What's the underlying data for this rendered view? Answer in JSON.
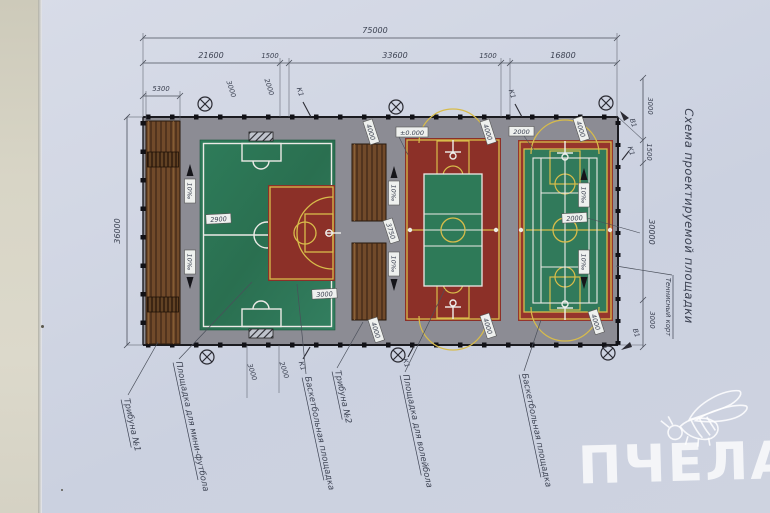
{
  "title": "Схема проектируемой площадки",
  "watermark": "ПЧЕЛА",
  "dims": {
    "overall_width": "75000",
    "seg_football": "21600",
    "gap_left": "1500",
    "seg_middle": "33600",
    "gap_right": "1500",
    "seg_tennis": "16800",
    "tribune_width": "5300",
    "height_left": "36000",
    "right_top": "3000",
    "right_fence": "1500",
    "right_court": "30000",
    "right_bottom": "3000",
    "top_3000": "3000",
    "top_2000": "2000",
    "bottom_3000": "3000",
    "bottom_2000": "2000",
    "tribune_gap": "3750",
    "offset_4000": "4000",
    "offset_2000": "2000"
  },
  "marks": {
    "k1": "К1",
    "v1": "В1",
    "slope": "10‰",
    "elevation_zero": "±0.000",
    "spot_2900": "2900",
    "spot_3000": "3000",
    "spot_2000": "2000"
  },
  "labels": {
    "tribune1": "Трибуна №1",
    "mini_football": "Площадка для мини-футбола",
    "basketball_left": "Баскетбольная площадка",
    "tribune2": "Трибуна №2",
    "volleyball": "Площадка для волейбола",
    "basketball_right": "Баскетбольная площадка",
    "tennis_court": "Теннисный корт"
  },
  "colors": {
    "court_red": "#8c3028",
    "court_green": "#2f7b59",
    "line_yellow": "#d8bc4a",
    "platform_gray": "#8c8c94",
    "tribune_brown": "#714a2a",
    "paper": "#cfd5e3"
  }
}
